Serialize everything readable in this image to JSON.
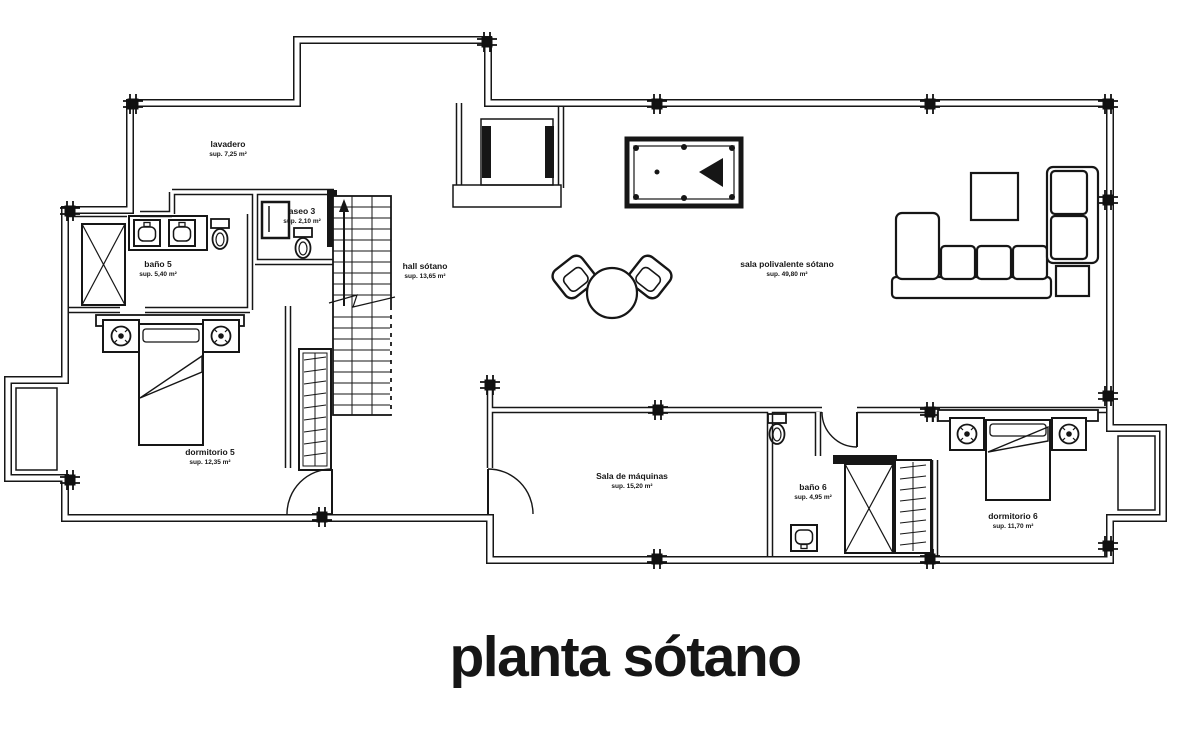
{
  "title": {
    "text": "planta sótano"
  },
  "plan": {
    "colors": {
      "ink": "#1b1b1b",
      "paper": "#ffffff"
    },
    "rooms": [
      {
        "name": "lavadero",
        "sup": "sup. 7,25 m²"
      },
      {
        "name": "baño 5",
        "sup": "sup. 5,40 m²"
      },
      {
        "name": "aseo 3",
        "sup": "sup. 2,10 m²"
      },
      {
        "name": "hall sótano",
        "sup": "sup. 13,65 m²"
      },
      {
        "name": "sala polivalente sótano",
        "sup": "sup. 49,80 m²"
      },
      {
        "name": "dormitorio 5",
        "sup": "sup. 12,35 m²"
      },
      {
        "name": "Sala de máquinas",
        "sup": "sup. 15,20 m²"
      },
      {
        "name": "baño 6",
        "sup": "sup. 4,95 m²"
      },
      {
        "name": "dormitorio 6",
        "sup": "sup. 11,70 m²"
      }
    ]
  }
}
